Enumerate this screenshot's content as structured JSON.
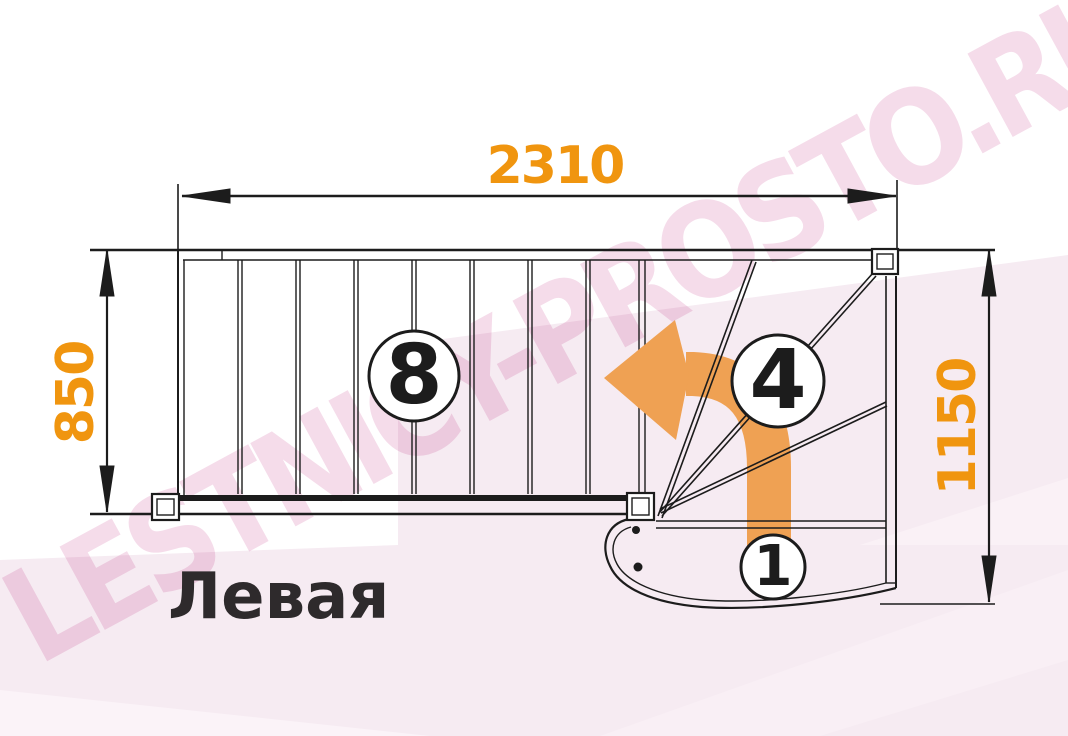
{
  "plan": {
    "title": "Левая",
    "watermark": "LESTNICY-PROSTO.RU",
    "dimensions": {
      "total_length_top": "2310",
      "flight_width_left": "850",
      "turn_section_right": "1150"
    },
    "step_counts": {
      "straight_flight": "8",
      "winder_steps": "4",
      "starting_step": "1"
    },
    "icons": {
      "direction_arrow": "curved-turn-left-arrow"
    },
    "colors": {
      "dimension_text": "#F0950F",
      "arrow_orange": "#EFA153",
      "line_black": "#1C1C1C",
      "watermark_pink": "#F5DCEA",
      "background_tint": "#F6EBF2"
    }
  }
}
